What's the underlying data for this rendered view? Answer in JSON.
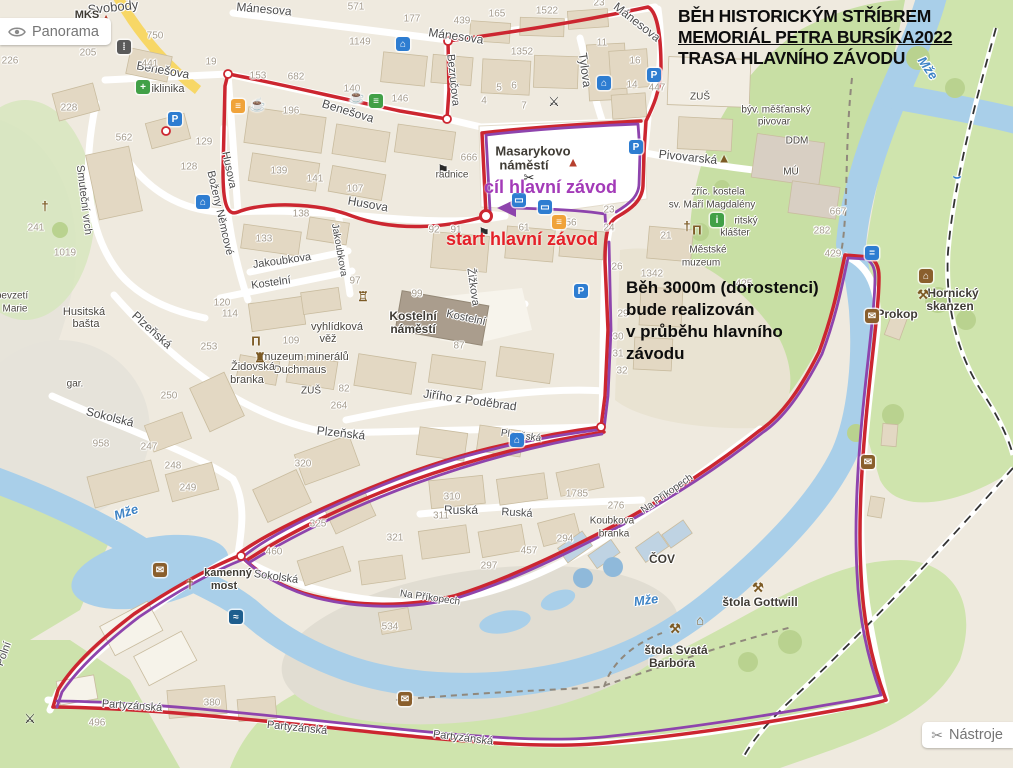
{
  "title": {
    "line1": "BĚH HISTORICKÝM STŘÍBREM",
    "line2": "MEMORIÁL PETRA BURSÍKA2022",
    "line3": "TRASA HLAVNÍHO ZÁVODU"
  },
  "buttons": {
    "panorama": "Panorama",
    "tools": "Nástroje"
  },
  "race": {
    "finish_label": "cíl hlavní závod",
    "start_label": "start hlavní závod",
    "note_lines": [
      "Běh 3000m (dorostenci)",
      "bude realizován",
      "v průběhu hlavního",
      "závodu"
    ]
  },
  "colors": {
    "route_red": "#cc2630",
    "route_purple": "#8e44ad",
    "finish_text": "#a33ab8",
    "start_text": "#e42028",
    "water": "#a9cfe9",
    "green": "#cfe3ab",
    "bg": "#efeadf"
  },
  "icon_glyphs": {
    "parking": "P",
    "hotel": "⌂",
    "bus": "▭",
    "swim": "≈",
    "info": "i",
    "shop": "≡",
    "clinic": "+",
    "basket": "≡",
    "mailbox": "✉",
    "minehouse": "⌂",
    "trafficlight": "⁞",
    "cafe": "☕",
    "drink": "☕",
    "restaurant": "⚔",
    "scissors": "✂",
    "flag": "⚑",
    "mine": "⚒",
    "museum": "Π",
    "castle": "♜",
    "tower": "♖",
    "belltower": "▲",
    "cross": "†",
    "hut": "⌂",
    "cone": "▲",
    "weir": "⌣",
    "bridgeicon": "="
  },
  "map": {
    "street_labels": [
      {
        "t": "Svobody",
        "x": 113,
        "y": 7,
        "r": -6,
        "s": 13
      },
      {
        "t": "Benešova",
        "x": 163,
        "y": 70,
        "r": 10,
        "s": 12
      },
      {
        "t": "Benešova",
        "x": 348,
        "y": 111,
        "r": 17,
        "s": 12
      },
      {
        "t": "Mánesova",
        "x": 264,
        "y": 9,
        "r": 5,
        "s": 12
      },
      {
        "t": "Mánesova",
        "x": 456,
        "y": 36,
        "r": 8,
        "s": 12
      },
      {
        "t": "Mánesova",
        "x": 637,
        "y": 22,
        "r": 38,
        "s": 12
      },
      {
        "t": "Bezručova",
        "x": 453,
        "y": 80,
        "r": 84,
        "s": 11
      },
      {
        "t": "Tylova",
        "x": 585,
        "y": 70,
        "r": 82,
        "s": 12
      },
      {
        "t": "Husova",
        "x": 368,
        "y": 204,
        "r": 10,
        "s": 12
      },
      {
        "t": "Husova",
        "x": 229,
        "y": 170,
        "r": 78,
        "s": 11
      },
      {
        "t": "Boženy Němcové",
        "x": 220,
        "y": 213,
        "r": 77,
        "s": 11
      },
      {
        "t": "Smuteční vrch",
        "x": 84,
        "y": 200,
        "r": 83,
        "s": 11
      },
      {
        "t": "Jakoubkova",
        "x": 282,
        "y": 261,
        "r": -8,
        "s": 11
      },
      {
        "t": "Jakoubkova",
        "x": 339,
        "y": 250,
        "r": 80,
        "s": 10
      },
      {
        "t": "Kostelní",
        "x": 271,
        "y": 283,
        "r": -8,
        "s": 11
      },
      {
        "t": "Kostelní",
        "x": 466,
        "y": 318,
        "r": 12,
        "s": 11
      },
      {
        "t": "Žižkova",
        "x": 473,
        "y": 287,
        "r": 82,
        "s": 11
      },
      {
        "t": "Pivovarská",
        "x": 688,
        "y": 157,
        "r": 6,
        "s": 12
      },
      {
        "t": "Jiřího z Poděbrad",
        "x": 470,
        "y": 400,
        "r": 8,
        "s": 12
      },
      {
        "t": "Plzeňská",
        "x": 152,
        "y": 330,
        "r": 42,
        "s": 12
      },
      {
        "t": "Plzeňská",
        "x": 341,
        "y": 433,
        "r": 6,
        "s": 12
      },
      {
        "t": "Plzeňská",
        "x": 521,
        "y": 436,
        "r": 8,
        "s": 10
      },
      {
        "t": "Sokolská",
        "x": 110,
        "y": 417,
        "r": 14,
        "s": 12
      },
      {
        "t": "Sokolská",
        "x": 276,
        "y": 577,
        "r": 8,
        "s": 11
      },
      {
        "t": "Ruská",
        "x": 461,
        "y": 510,
        "r": 0,
        "s": 12
      },
      {
        "t": "Ruská",
        "x": 517,
        "y": 513,
        "r": 3,
        "s": 11
      },
      {
        "t": "Na Příkopech",
        "x": 430,
        "y": 598,
        "r": 8,
        "s": 10
      },
      {
        "t": "Na Příkopech",
        "x": 667,
        "y": 494,
        "r": -35,
        "s": 10
      },
      {
        "t": "Partyzánská",
        "x": 132,
        "y": 706,
        "r": 4,
        "s": 11
      },
      {
        "t": "Partyzánská",
        "x": 297,
        "y": 728,
        "r": 6,
        "s": 11
      },
      {
        "t": "Partyzánská",
        "x": 463,
        "y": 738,
        "r": 7,
        "s": 11
      },
      {
        "t": "Polní",
        "x": 4,
        "y": 654,
        "r": -70,
        "s": 11
      }
    ],
    "place_labels": [
      {
        "t": "MKS",
        "x": 87,
        "y": 15,
        "b": 1,
        "s": 11
      },
      {
        "t": "Masarykovo",
        "x": 533,
        "y": 151,
        "b": 1,
        "s": 13
      },
      {
        "t": "náměstí",
        "x": 524,
        "y": 165,
        "b": 1,
        "s": 13
      },
      {
        "t": "Kostelní",
        "x": 413,
        "y": 316,
        "b": 1,
        "s": 12
      },
      {
        "t": "náměstí",
        "x": 413,
        "y": 329,
        "b": 1,
        "s": 12
      },
      {
        "t": "vyhlídková",
        "x": 337,
        "y": 327,
        "s": 11
      },
      {
        "t": "věž",
        "x": 328,
        "y": 339,
        "s": 11
      },
      {
        "t": "muzeum minerálů",
        "x": 305,
        "y": 357,
        "s": 11
      },
      {
        "t": "Duchmaus",
        "x": 300,
        "y": 370,
        "s": 11
      },
      {
        "t": "Židovská",
        "x": 253,
        "y": 367,
        "s": 11
      },
      {
        "t": "branka",
        "x": 247,
        "y": 380,
        "s": 11
      },
      {
        "t": "ZUŠ",
        "x": 311,
        "y": 391,
        "s": 10
      },
      {
        "t": "ZUŠ",
        "x": 700,
        "y": 97,
        "s": 10
      },
      {
        "t": "DDM",
        "x": 797,
        "y": 141,
        "s": 10
      },
      {
        "t": "MÚ",
        "x": 791,
        "y": 172,
        "s": 10
      },
      {
        "t": "zříc. kostela",
        "x": 718,
        "y": 192,
        "s": 10
      },
      {
        "t": "sv. Maří Magdalény",
        "x": 712,
        "y": 205,
        "s": 10
      },
      {
        "t": "ritský",
        "x": 746,
        "y": 221,
        "s": 10
      },
      {
        "t": "klášter",
        "x": 735,
        "y": 233,
        "s": 10
      },
      {
        "t": "Městské",
        "x": 708,
        "y": 250,
        "s": 10
      },
      {
        "t": "muzeum",
        "x": 701,
        "y": 263,
        "s": 10
      },
      {
        "t": "býv. měšťanský",
        "x": 776,
        "y": 110,
        "s": 10
      },
      {
        "t": "pivovar",
        "x": 774,
        "y": 122,
        "s": 10
      },
      {
        "t": "Hornický",
        "x": 953,
        "y": 293,
        "b": 1,
        "s": 12
      },
      {
        "t": "skanzen",
        "x": 950,
        "y": 306,
        "b": 1,
        "s": 12
      },
      {
        "t": "Prokop",
        "x": 897,
        "y": 314,
        "b": 1,
        "s": 12
      },
      {
        "t": "ČOV",
        "x": 662,
        "y": 559,
        "b": 1,
        "s": 12
      },
      {
        "t": "štola Gottwill",
        "x": 760,
        "y": 602,
        "b": 1,
        "s": 12
      },
      {
        "t": "štola Svatá",
        "x": 676,
        "y": 650,
        "b": 1,
        "s": 12
      },
      {
        "t": "Barbora",
        "x": 672,
        "y": 663,
        "b": 1,
        "s": 12
      },
      {
        "t": "Husitská",
        "x": 84,
        "y": 312,
        "s": 11
      },
      {
        "t": "bašta",
        "x": 86,
        "y": 324,
        "s": 11
      },
      {
        "t": "gar.",
        "x": 75,
        "y": 384,
        "s": 10
      },
      {
        "t": "bevzetí",
        "x": 12,
        "y": 296,
        "s": 10
      },
      {
        "t": "Marie",
        "x": 15,
        "y": 309,
        "s": 10
      },
      {
        "t": "kamenný",
        "x": 228,
        "y": 573,
        "b": 1,
        "s": 11
      },
      {
        "t": "most",
        "x": 224,
        "y": 586,
        "b": 1,
        "s": 11
      },
      {
        "t": "iklinika",
        "x": 168,
        "y": 89,
        "s": 11
      },
      {
        "t": "radnice",
        "x": 452,
        "y": 175,
        "s": 10
      },
      {
        "t": "Koubkova",
        "x": 612,
        "y": 521,
        "s": 10
      },
      {
        "t": "branka",
        "x": 614,
        "y": 534,
        "s": 10
      }
    ],
    "water_labels": [
      {
        "t": "Mže",
        "x": 126,
        "y": 512,
        "r": -18,
        "s": 13
      },
      {
        "t": "Mže",
        "x": 646,
        "y": 600,
        "r": -8,
        "s": 13
      },
      {
        "t": "Mže",
        "x": 928,
        "y": 68,
        "r": 55,
        "s": 13
      }
    ],
    "numbers": [
      {
        "t": "226",
        "x": 10,
        "y": 61
      },
      {
        "t": "750",
        "x": 155,
        "y": 36
      },
      {
        "t": "205",
        "x": 88,
        "y": 53
      },
      {
        "t": "19",
        "x": 211,
        "y": 62
      },
      {
        "t": "441",
        "x": 150,
        "y": 64
      },
      {
        "t": "228",
        "x": 69,
        "y": 108
      },
      {
        "t": "562",
        "x": 124,
        "y": 138
      },
      {
        "t": "129",
        "x": 204,
        "y": 142
      },
      {
        "t": "128",
        "x": 189,
        "y": 167
      },
      {
        "t": "139",
        "x": 279,
        "y": 171
      },
      {
        "t": "141",
        "x": 315,
        "y": 179
      },
      {
        "t": "107",
        "x": 355,
        "y": 189
      },
      {
        "t": "138",
        "x": 301,
        "y": 214
      },
      {
        "t": "133",
        "x": 264,
        "y": 239
      },
      {
        "t": "241",
        "x": 36,
        "y": 228
      },
      {
        "t": "1019",
        "x": 65,
        "y": 253
      },
      {
        "t": "153",
        "x": 258,
        "y": 76
      },
      {
        "t": "682",
        "x": 296,
        "y": 77
      },
      {
        "t": "196",
        "x": 291,
        "y": 111
      },
      {
        "t": "140",
        "x": 352,
        "y": 89
      },
      {
        "t": "146",
        "x": 400,
        "y": 99
      },
      {
        "t": "571",
        "x": 356,
        "y": 7
      },
      {
        "t": "177",
        "x": 412,
        "y": 19
      },
      {
        "t": "439",
        "x": 462,
        "y": 21
      },
      {
        "t": "165",
        "x": 497,
        "y": 14
      },
      {
        "t": "1522",
        "x": 547,
        "y": 11
      },
      {
        "t": "23",
        "x": 599,
        "y": 3
      },
      {
        "t": "1149",
        "x": 360,
        "y": 42
      },
      {
        "t": "1352",
        "x": 522,
        "y": 52
      },
      {
        "t": "11",
        "x": 602,
        "y": 43
      },
      {
        "t": "16",
        "x": 635,
        "y": 61
      },
      {
        "t": "14",
        "x": 632,
        "y": 85
      },
      {
        "t": "4",
        "x": 484,
        "y": 101
      },
      {
        "t": "5",
        "x": 499,
        "y": 88
      },
      {
        "t": "6",
        "x": 514,
        "y": 86
      },
      {
        "t": "7",
        "x": 524,
        "y": 106
      },
      {
        "t": "447",
        "x": 657,
        "y": 88
      },
      {
        "t": "666",
        "x": 469,
        "y": 158
      },
      {
        "t": "92",
        "x": 434,
        "y": 230
      },
      {
        "t": "91",
        "x": 456,
        "y": 230
      },
      {
        "t": "61",
        "x": 524,
        "y": 228
      },
      {
        "t": "56",
        "x": 571,
        "y": 223
      },
      {
        "t": "23",
        "x": 609,
        "y": 210
      },
      {
        "t": "24",
        "x": 609,
        "y": 228
      },
      {
        "t": "21",
        "x": 666,
        "y": 236
      },
      {
        "t": "97",
        "x": 355,
        "y": 281
      },
      {
        "t": "99",
        "x": 417,
        "y": 294
      },
      {
        "t": "87",
        "x": 459,
        "y": 346
      },
      {
        "t": "120",
        "x": 222,
        "y": 303
      },
      {
        "t": "114",
        "x": 230,
        "y": 314
      },
      {
        "t": "109",
        "x": 291,
        "y": 341
      },
      {
        "t": "253",
        "x": 209,
        "y": 347
      },
      {
        "t": "82",
        "x": 344,
        "y": 389
      },
      {
        "t": "264",
        "x": 339,
        "y": 406
      },
      {
        "t": "250",
        "x": 169,
        "y": 396
      },
      {
        "t": "958",
        "x": 101,
        "y": 444
      },
      {
        "t": "247",
        "x": 149,
        "y": 447
      },
      {
        "t": "248",
        "x": 173,
        "y": 466
      },
      {
        "t": "249",
        "x": 188,
        "y": 488
      },
      {
        "t": "320",
        "x": 303,
        "y": 464
      },
      {
        "t": "310",
        "x": 452,
        "y": 497
      },
      {
        "t": "311",
        "x": 441,
        "y": 516
      },
      {
        "t": "1785",
        "x": 577,
        "y": 494
      },
      {
        "t": "276",
        "x": 616,
        "y": 506
      },
      {
        "t": "294",
        "x": 565,
        "y": 539
      },
      {
        "t": "457",
        "x": 529,
        "y": 551
      },
      {
        "t": "297",
        "x": 489,
        "y": 566
      },
      {
        "t": "321",
        "x": 395,
        "y": 538
      },
      {
        "t": "325",
        "x": 318,
        "y": 524
      },
      {
        "t": "460",
        "x": 274,
        "y": 552
      },
      {
        "t": "534",
        "x": 390,
        "y": 627
      },
      {
        "t": "380",
        "x": 212,
        "y": 703
      },
      {
        "t": "496",
        "x": 97,
        "y": 723
      },
      {
        "t": "667",
        "x": 838,
        "y": 212
      },
      {
        "t": "282",
        "x": 822,
        "y": 231
      },
      {
        "t": "429",
        "x": 833,
        "y": 254
      },
      {
        "t": "425",
        "x": 744,
        "y": 284
      },
      {
        "t": "26",
        "x": 617,
        "y": 267
      },
      {
        "t": "29",
        "x": 623,
        "y": 314
      },
      {
        "t": "30",
        "x": 618,
        "y": 337
      },
      {
        "t": "31",
        "x": 618,
        "y": 354
      },
      {
        "t": "32",
        "x": 622,
        "y": 371
      },
      {
        "t": "1342",
        "x": 652,
        "y": 274
      }
    ],
    "icons": [
      {
        "k": "parking",
        "x": 175,
        "y": 119
      },
      {
        "k": "parking",
        "x": 654,
        "y": 75
      },
      {
        "k": "parking",
        "x": 636,
        "y": 147
      },
      {
        "k": "parking",
        "x": 581,
        "y": 291
      },
      {
        "k": "hotel",
        "x": 403,
        "y": 44
      },
      {
        "k": "hotel",
        "x": 604,
        "y": 83
      },
      {
        "k": "hotel",
        "x": 203,
        "y": 202
      },
      {
        "k": "hotel",
        "x": 517,
        "y": 440
      },
      {
        "k": "cafe",
        "x": 357,
        "y": 97
      },
      {
        "k": "drink",
        "x": 258,
        "y": 105
      },
      {
        "k": "basket",
        "x": 238,
        "y": 106
      },
      {
        "k": "basket",
        "x": 559,
        "y": 222
      },
      {
        "k": "shop",
        "x": 376,
        "y": 101
      },
      {
        "k": "restaurant",
        "x": 554,
        "y": 102
      },
      {
        "k": "restaurant",
        "x": 30,
        "y": 719
      },
      {
        "k": "clinic",
        "x": 143,
        "y": 87
      },
      {
        "k": "museum",
        "x": 256,
        "y": 341
      },
      {
        "k": "museum",
        "x": 697,
        "y": 230
      },
      {
        "k": "castle",
        "x": 260,
        "y": 358
      },
      {
        "k": "tower",
        "x": 363,
        "y": 297
      },
      {
        "k": "belltower",
        "x": 724,
        "y": 158
      },
      {
        "k": "cone",
        "x": 106,
        "y": 18
      },
      {
        "k": "cone",
        "x": 573,
        "y": 162
      },
      {
        "k": "info",
        "x": 717,
        "y": 220
      },
      {
        "k": "mine",
        "x": 923,
        "y": 295
      },
      {
        "k": "mine",
        "x": 758,
        "y": 588
      },
      {
        "k": "mine",
        "x": 675,
        "y": 629
      },
      {
        "k": "minehouse",
        "x": 926,
        "y": 276
      },
      {
        "k": "hut",
        "x": 700,
        "y": 620
      },
      {
        "k": "mailbox",
        "x": 160,
        "y": 570
      },
      {
        "k": "mailbox",
        "x": 868,
        "y": 462
      },
      {
        "k": "mailbox",
        "x": 405,
        "y": 699
      },
      {
        "k": "mailbox",
        "x": 872,
        "y": 316
      },
      {
        "k": "swim",
        "x": 236,
        "y": 617
      },
      {
        "k": "weir",
        "x": 957,
        "y": 177
      },
      {
        "k": "cross",
        "x": 45,
        "y": 206
      },
      {
        "k": "cross",
        "x": 190,
        "y": 584
      },
      {
        "k": "cross",
        "x": 687,
        "y": 226
      },
      {
        "k": "trafficlight",
        "x": 124,
        "y": 47
      },
      {
        "k": "bus",
        "x": 519,
        "y": 200
      },
      {
        "k": "bus",
        "x": 545,
        "y": 207
      },
      {
        "k": "scissors",
        "x": 529,
        "y": 178
      },
      {
        "k": "flag",
        "x": 443,
        "y": 170
      },
      {
        "k": "flag",
        "x": 484,
        "y": 233
      },
      {
        "k": "bridgeicon",
        "x": 872,
        "y": 253
      }
    ]
  }
}
